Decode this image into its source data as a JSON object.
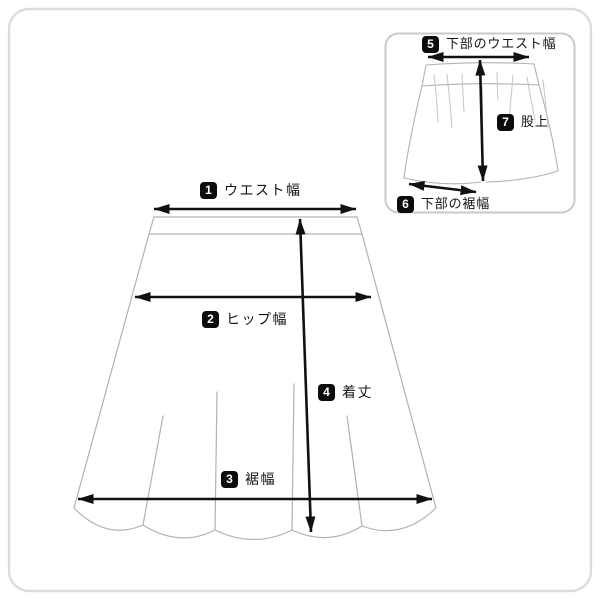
{
  "colors": {
    "background": "#ffffff",
    "outer_border": "#dcdcdc",
    "inset_border": "#c9c9c9",
    "garment_line": "#b2b2b2",
    "pleat_line": "#c6c6c6",
    "measure_line": "#111111",
    "badge_background": "#0c0c0c",
    "badge_text": "#ffffff",
    "label_text": "#151515"
  },
  "main_view": {
    "garment": "skirt-front-view",
    "measurements": [
      {
        "num": "1",
        "label": "ウエスト幅"
      },
      {
        "num": "2",
        "label": "ヒップ幅"
      },
      {
        "num": "3",
        "label": "裾幅"
      },
      {
        "num": "4",
        "label": "着丈"
      }
    ]
  },
  "inset_view": {
    "garment": "inner-shorts-view",
    "measurements": [
      {
        "num": "5",
        "label": "下部のウエスト幅"
      },
      {
        "num": "6",
        "label": "下部の裾幅"
      },
      {
        "num": "7",
        "label": "股上"
      }
    ]
  }
}
